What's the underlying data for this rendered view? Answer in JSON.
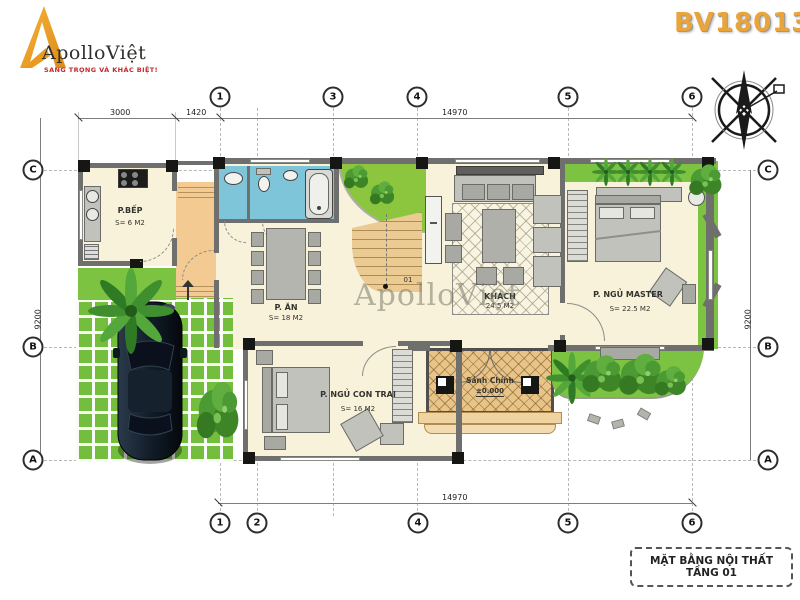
{
  "header": {
    "brand": "ApolloViệt",
    "tagline": "SANG TRỌNG VÀ KHÁC BIỆT!",
    "drawing_code": "BV18013"
  },
  "watermark": "ApolloViệt",
  "title_box": {
    "label": "MẶT BẰNG NỘI THẤT TẦNG 01"
  },
  "grid": {
    "top": [
      "1",
      "3",
      "4",
      "5",
      "6"
    ],
    "bottom": [
      "1",
      "2",
      "4",
      "5",
      "6"
    ],
    "left": [
      "C",
      "B",
      "A"
    ],
    "right": [
      "C",
      "B",
      "A"
    ]
  },
  "dimensions": {
    "top_seg1": "3000",
    "top_seg2": "1420",
    "top_total": "14970",
    "bottom_total": "14970",
    "left_total": "9200",
    "right_total": "9200"
  },
  "rooms": {
    "kitchen": {
      "name": "P.BẾP",
      "area": "S= 6 M2"
    },
    "dining": {
      "name": "P. ĂN",
      "area": "S= 18 M2"
    },
    "living": {
      "name": "KHÁCH",
      "area": "24.5 M2"
    },
    "master": {
      "name": "P. NGỦ MASTER",
      "area": "S= 22.5 M2"
    },
    "boy": {
      "name": "P. NGỦ CON TRAI",
      "area": "S= 16 M2"
    },
    "entry": {
      "name": "Sảnh Chính",
      "level": "±0.000"
    }
  },
  "stair": {
    "label": "01"
  },
  "colors": {
    "brand_orange": "#F2A32C",
    "tagline_red": "#C4272B",
    "code_gold": "#E8A43C",
    "floor_cream": "#F8F2DA",
    "terrace_orange": "#F3CB92",
    "bath_blue": "#7FC5D9",
    "grass_green": "#7CC342",
    "porch_tan": "#E6C083",
    "wall_gray": "#6F6F6E"
  }
}
